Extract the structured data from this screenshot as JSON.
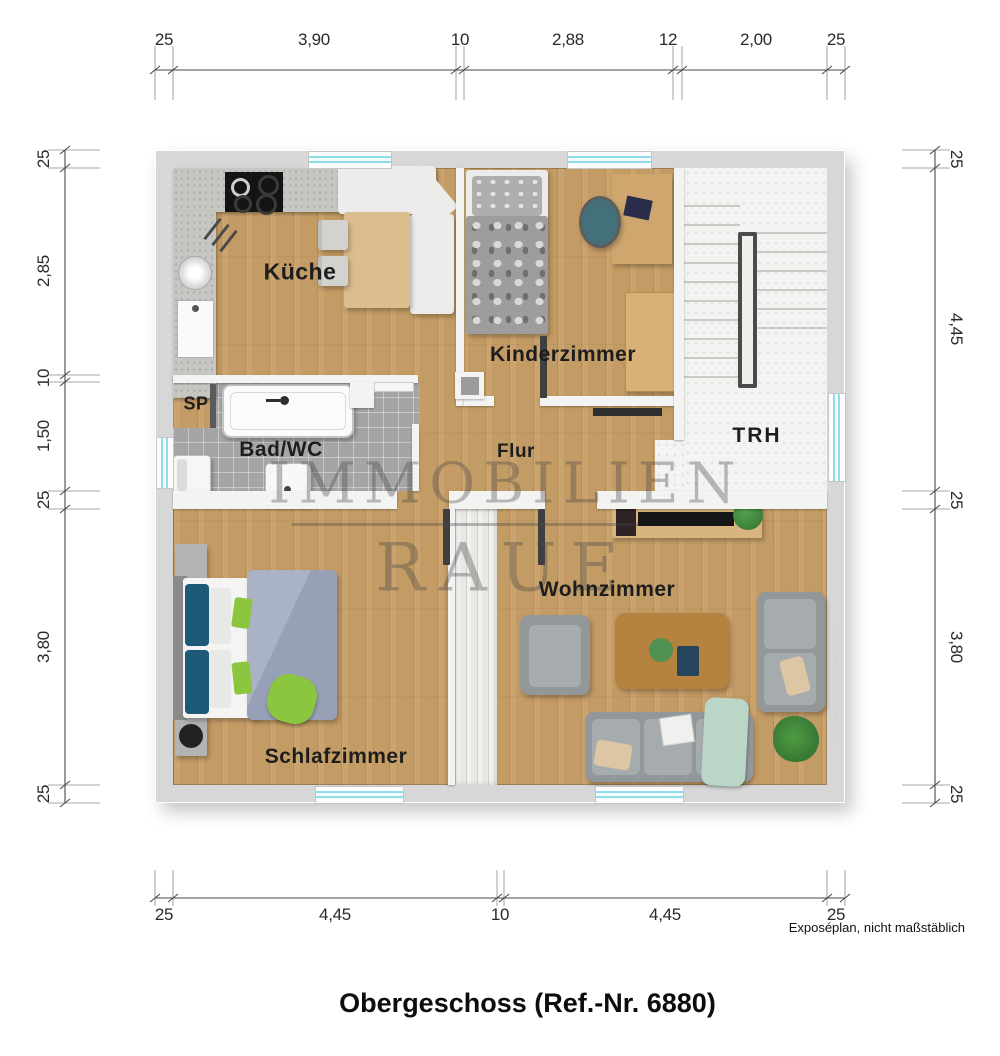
{
  "title": "Obergeschoss (Ref.-Nr. 6880)",
  "watermark": {
    "line1": "IMMOBILIEN",
    "line2": "RAUE"
  },
  "notes": {
    "disclaimer": "Exposéplan, nicht maßstäblich",
    "credit": "Illustration©ImmoGrafik"
  },
  "rooms": {
    "kueche": "Küche",
    "kinderzimmer": "Kinderzimmer",
    "trh": "TRH",
    "sp": "SP",
    "bad": "Bad/WC",
    "flur": "Flur",
    "schlafzimmer": "Schlafzimmer",
    "wohnzimmer": "Wohnzimmer"
  },
  "dimensions": {
    "top": [
      "25",
      "3,90",
      "10",
      "2,88",
      "12",
      "2,00",
      "25"
    ],
    "bottom": [
      "25",
      "4,45",
      "10",
      "4,45",
      "25"
    ],
    "left": [
      "25",
      "2,85",
      "10",
      "1,50",
      "25",
      "3,80",
      "25"
    ],
    "right": [
      "25",
      "4,45",
      "25",
      "3,80",
      "25"
    ]
  },
  "palette": {
    "wood": "#c79e66",
    "tile": "#a5a5a5",
    "window_glass": "#8edde9",
    "outer_wall": "#d7d7d7",
    "stair_floor": "#f3f3f1",
    "door_dark": "#3f3f3f",
    "sofa_grey": "#92989a",
    "accent_green": "#8cc63f"
  }
}
